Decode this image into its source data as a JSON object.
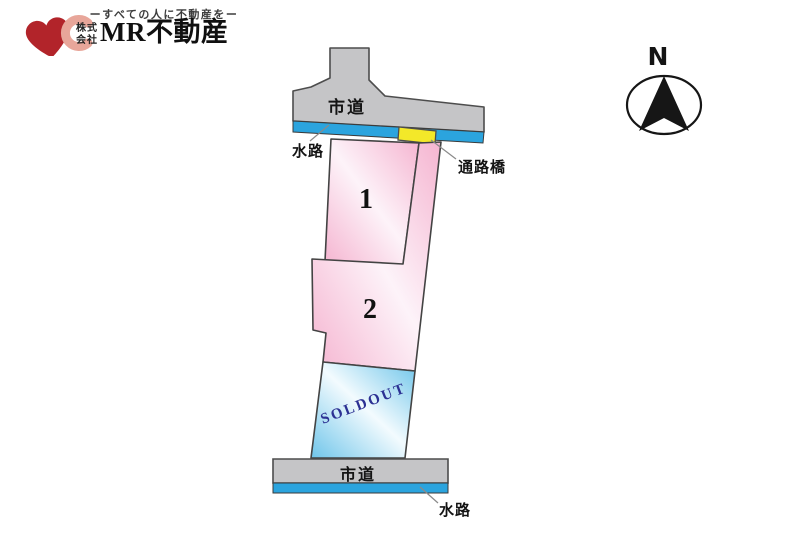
{
  "logo": {
    "tagline": "ーすべての人に不動産をー",
    "company_prefix_top": "株式",
    "company_prefix_bottom": "会社",
    "company_name": "MR不動産"
  },
  "compass": {
    "north_label": "N"
  },
  "plan": {
    "top_road_label": "市道",
    "top_waterway_label": "水路",
    "bridge_label": "通路橋",
    "lot1_label": "1",
    "lot2_label": "2",
    "sold_lot_label": "SOLDOUT",
    "bottom_road_label": "市道",
    "bottom_waterway_label": "水路"
  },
  "colors": {
    "road_gray": "#c5c5c7",
    "waterway_blue": "#2ba4de",
    "bridge_yellow": "#f3e829",
    "lot_pink": "#f5b4d0",
    "lot_pink_light": "#fdf3f9",
    "sold_blue": "#6fc5ea",
    "sold_blue_light": "#f3fbfe",
    "soldout_text": "#2c3193",
    "outline_dark": "#434343",
    "logo_red": "#b2242a",
    "logo_pink": "#e8a69a"
  }
}
